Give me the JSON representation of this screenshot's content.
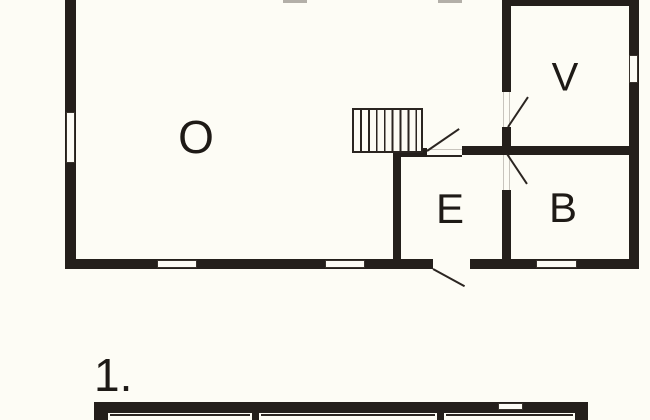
{
  "colors": {
    "background": "#fdfcf5",
    "wall": "#241f1b",
    "line": "#2b2521",
    "faint_line": "#c8c4bd"
  },
  "upper_floor": {
    "rooms": {
      "o": "O",
      "v": "V",
      "e": "E",
      "b": "B"
    },
    "features": {
      "staircase": "hatched-stair-run",
      "window_count": 5,
      "door_swing_count": 4
    }
  },
  "lower_floor": {
    "label": "1."
  }
}
